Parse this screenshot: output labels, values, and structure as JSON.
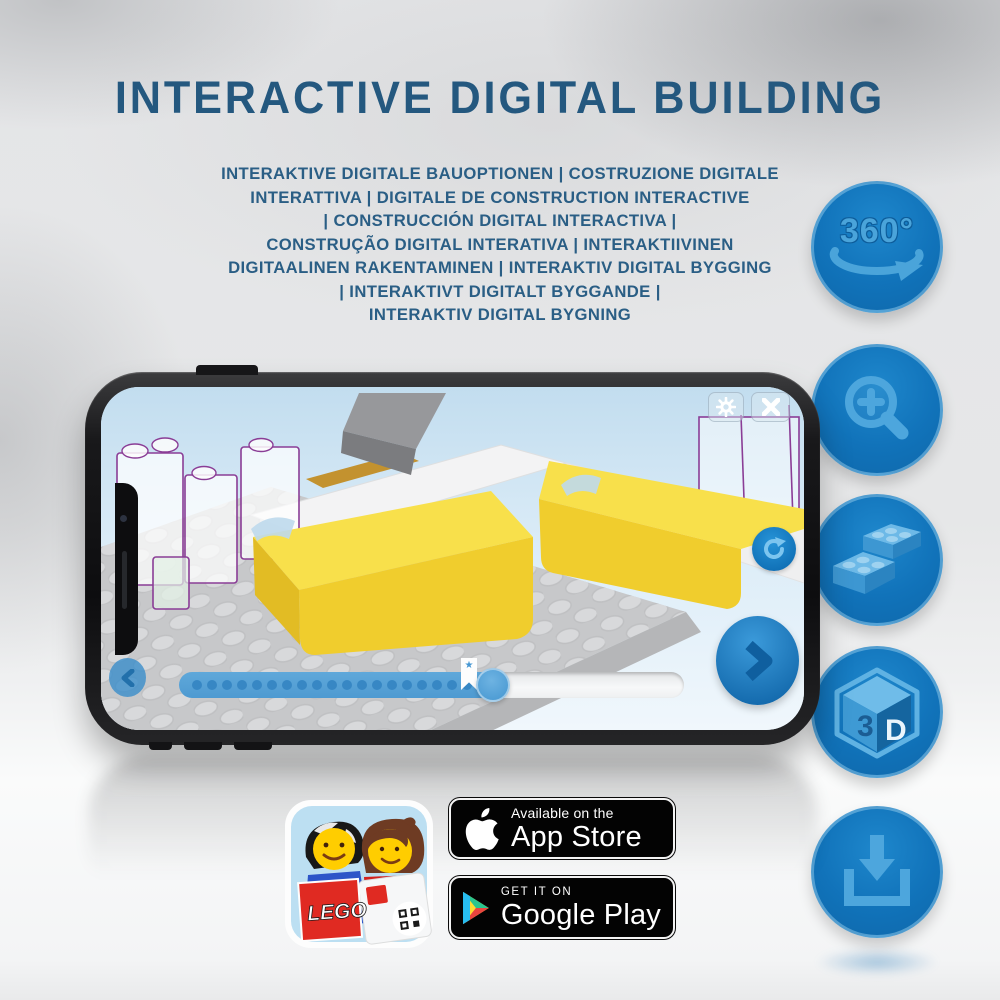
{
  "title": "INTERACTIVE DIGITAL BUILDING",
  "subtitle_lines": [
    "INTERAKTIVE DIGITALE BAUOPTIONEN | COSTRUZIONE DIGITALE",
    "INTERATTIVA | DIGITALE DE CONSTRUCTION INTERACTIVE",
    "| CONSTRUCCIÓN DIGITAL INTERACTIVA |",
    "CONSTRUÇÃO DIGITAL INTERATIVA | INTERAKTIIVINEN",
    "DIGITAALINEN RAKENTAMINEN | INTERAKTIV DIGITAL BYGGING",
    "| INTERAKTIVT DIGITALT BYGGANDE |",
    "INTERAKTIV DIGITAL BYGNING"
  ],
  "feature_circles": {
    "rotate_360": {
      "label": "360°",
      "icon": "rotate-360-icon"
    },
    "zoom": {
      "icon": "zoom-in-icon"
    },
    "bricks": {
      "icon": "bricks-icon"
    },
    "cube_3d": {
      "icon": "3d-cube-icon",
      "front_letter": "3",
      "side_letter": "D"
    },
    "download": {
      "icon": "download-icon"
    }
  },
  "phone": {
    "app_ui": {
      "buttons": [
        "gear-icon",
        "close-icon",
        "rotate-icon",
        "back-icon",
        "next-icon"
      ],
      "progress": {
        "dots": 20,
        "filled_ratio": 0.65,
        "bookmark_ratio": 0.43,
        "bookmark_icon": "star-icon",
        "star": "★"
      }
    }
  },
  "app_icon": {
    "lego_logo_text": "LEGO"
  },
  "store_badges": {
    "app_store": {
      "line1": "Available on the",
      "line2": "App Store",
      "icon": "apple-icon"
    },
    "google_play": {
      "line1": "GET IT ON",
      "line2": "Google Play",
      "icon": "google-play-icon"
    }
  },
  "colors": {
    "title_blue": "#24587f",
    "circle_blue": "#1173ba",
    "icon_glyph_blue": "#4da6dd",
    "progress_fill": "#57a1d6",
    "lego_yellow": "#f2d53d",
    "lego_red": "#d01012",
    "ghost_outline_purple": "#8a3d96",
    "badge_black": "#030303"
  }
}
